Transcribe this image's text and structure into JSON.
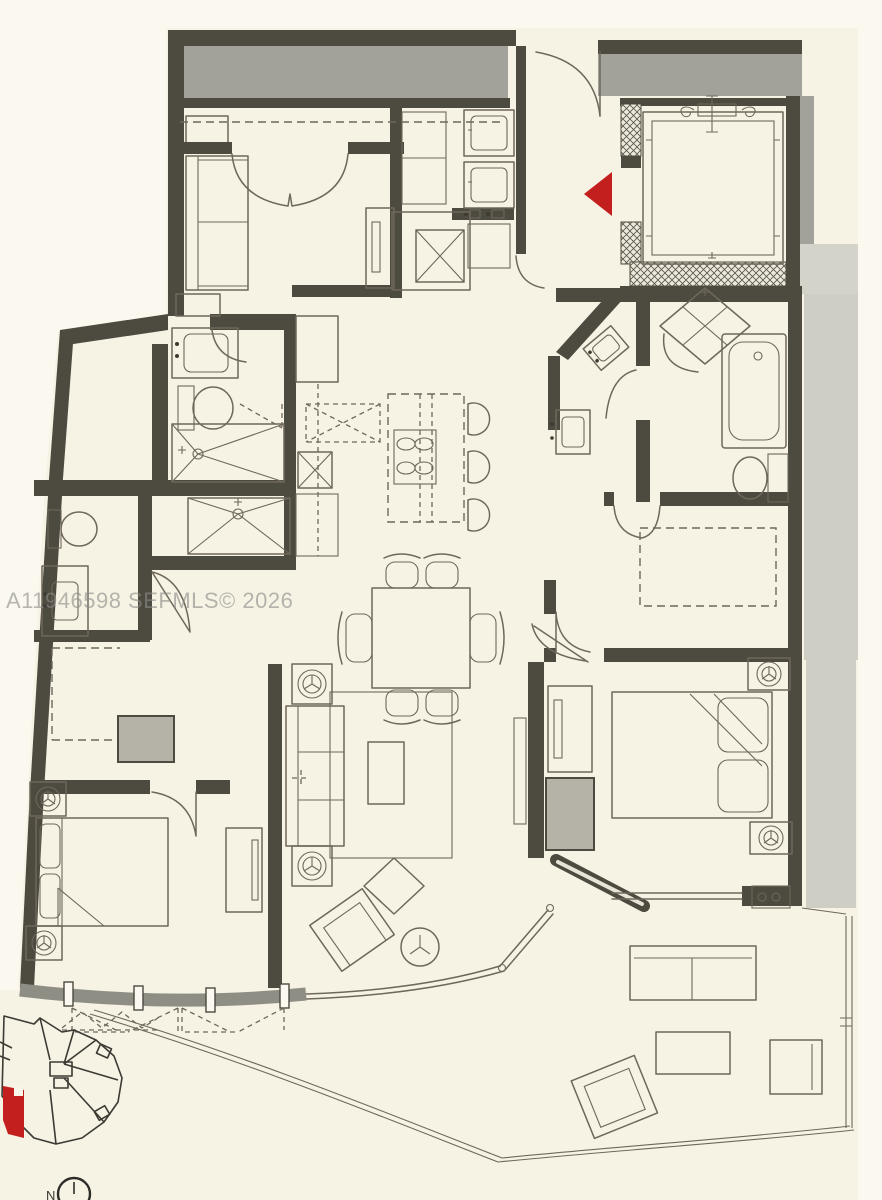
{
  "watermark": {
    "text": "A11946598 SEFMLS© 2026"
  },
  "north_indicator": {
    "label": "N"
  },
  "palette": {
    "background": "#f6f2e4",
    "wall_dark": "#4d4a40",
    "poche_gray": "#a3a29a",
    "poche_light": "#cfcec5",
    "drawing_line": "#6e685b",
    "accent_red": "#c41f1f",
    "hatch_background": "#ece8da"
  },
  "key_plan": {
    "highlight_color": "#c41f1f"
  },
  "floor_plan": {
    "rooms": [
      "den",
      "entry-foyer",
      "laundry",
      "service-elevator",
      "private-elevator",
      "kitchen",
      "dining-area",
      "living-room",
      "primary-bedroom",
      "primary-bathroom",
      "primary-walk-in-closet",
      "bathroom-2",
      "bedroom-2",
      "bedroom-2-bathroom",
      "bedroom-2-closet",
      "terrace",
      "balcony-window-wall"
    ],
    "fixtures": [
      "sofa",
      "stacked-washer-dryer",
      "kitchen-island-cooktop",
      "bar-stools",
      "dining-table-6-chairs",
      "king-bed",
      "queen-bed",
      "bathtub",
      "showers",
      "toilets",
      "vanity-sinks",
      "outdoor-sofa",
      "lounge-chairs",
      "coffee-tables",
      "nightstand-lamps"
    ]
  }
}
